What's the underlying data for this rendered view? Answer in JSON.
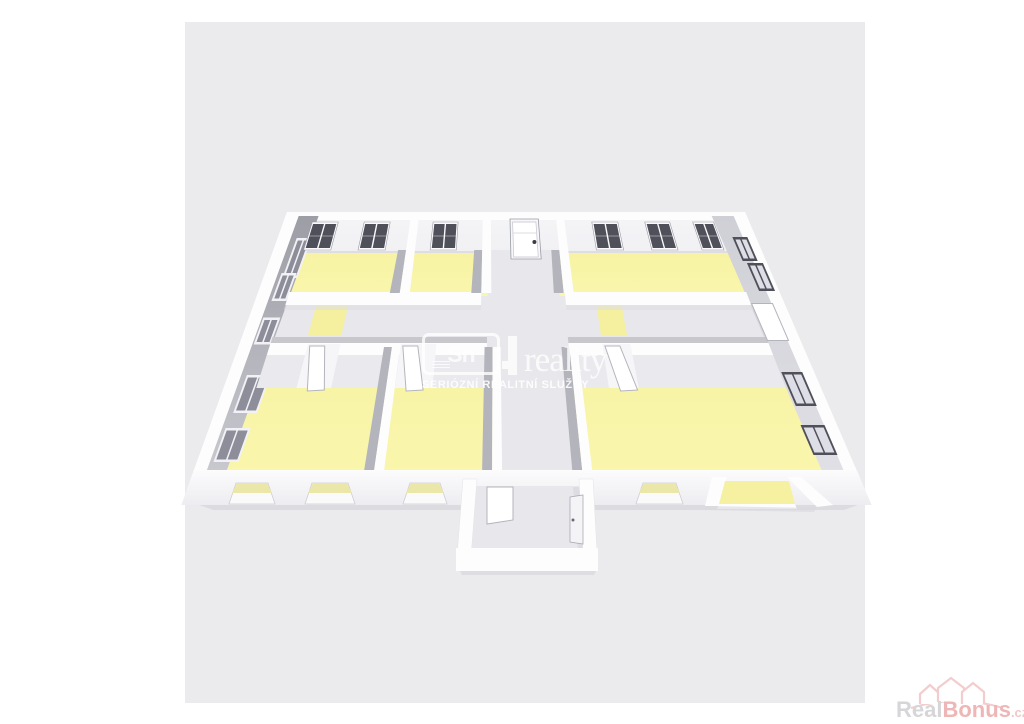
{
  "scene": {
    "description": "3D isometric rendering of an apartment floor plan",
    "yellow_rooms": 6,
    "corridor_shape": "T",
    "entrance_vestibule": true,
    "balcony": true
  },
  "watermark": {
    "logo_text": "Sn",
    "brand": "reality",
    "tagline": "SERIÓZNÍ REALITNÍ SLUŽBY"
  },
  "footer_logo": {
    "real": "Real",
    "bonus": "Bonus",
    "tld": ".cz"
  },
  "colors": {
    "page_bg": "#ffffff",
    "canvas_bg": "#ebebed",
    "floor_yellow": "#f8f3a3",
    "floor_yellow_front": "#f9f6ad",
    "threshold_yellow": "#f5f0a0",
    "corridor_floor": "#e8e8ec",
    "wall_top": "#fdfdfe",
    "back_slope": "#f1f1f4",
    "back_lip": "#dddde2",
    "left_face_dark": "#9d9da6",
    "left_face_light": "#c9c9d0",
    "right_face_top": "#cfcfd6",
    "right_face_bottom": "#e0e0e6",
    "interior_wall_gray": "#b4b4bc",
    "band_shadow": "#c7c7cc",
    "face_front": "#e9e9ee",
    "window_dark": "#50505b",
    "window_pane_light": "#dddee6",
    "window_frame_light": "#f2f2f6",
    "window_pane_gray": "#8e8e9a",
    "door_white": "#ffffff",
    "door_outline": "#b4b4bd",
    "opening_glow": "#eae7a8",
    "slab_shadow": "#d9d9de",
    "front_wall_top": "#fcfcfd",
    "front_wall_bottom": "#ededf1",
    "brand_gray": "#d6d6d8",
    "brand_pink": "#eeb6b6",
    "brand_pink_light": "#f3cdcd"
  }
}
